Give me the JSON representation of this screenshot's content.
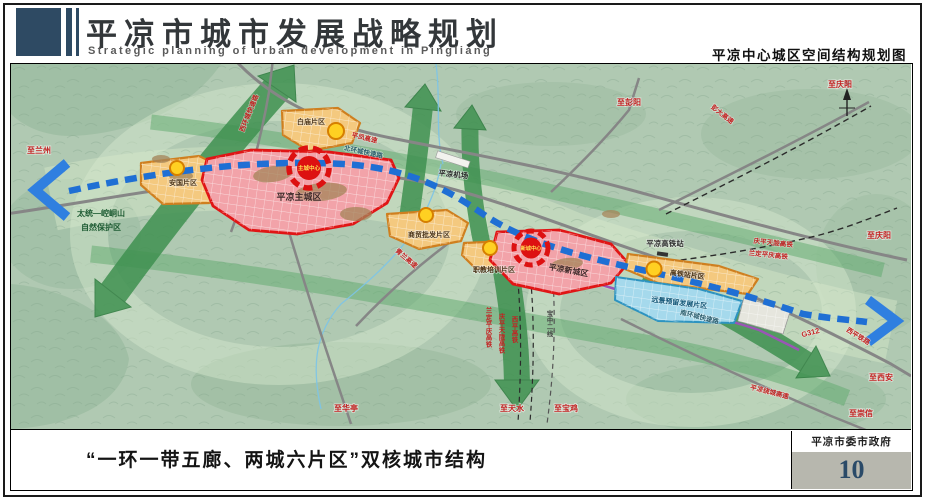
{
  "header": {
    "title": "平凉市城市发展战略规划",
    "subtitle": "Strategic planning of urban development in Pingliang",
    "right_caption": "平凉中心城区空间结构规划图"
  },
  "footer": {
    "caption": "“一环一带五廊、两城六片区”双核城市结构",
    "agency": "平凉市委市政府",
    "page_number": "10"
  },
  "map": {
    "compass_label": "N",
    "districts": {
      "main_city": "平凉主城区",
      "new_city": "平凉新城区",
      "anguo": "安国片区",
      "baimiao": "白庙片区",
      "trade_wholesale": "商贸批发片区",
      "vocational": "职教培训片区",
      "hsr_area": "高铁站片区",
      "reserved": "远景预留发展片区"
    },
    "centers": {
      "main_center": "主城中心",
      "new_center": "新城中心"
    },
    "nature_reserve": {
      "line1": "太统—崆峒山",
      "line2": "自然保护区"
    },
    "facilities": {
      "airport": "平凉机场",
      "hsr_station": "平凉高铁站"
    },
    "roads": {
      "west_ring": "西环城快速路",
      "north_ring": "北环城快速路",
      "south_ring": "南环城快速路",
      "pengda_expressway": "彭大高速",
      "pingfeng_expressway": "平凤高速",
      "qinglan_expressway": "青兰高速",
      "ring_expressway": "平凉绕城高速",
      "g312": "G312"
    },
    "railways": {
      "qptl_hsr_right": "庆平天陇高铁",
      "ldpq_hsr_right": "兰定平庆高铁",
      "ldpq_hsr_south": "兰定平庆高铁",
      "qptl_hsr_south": "庆平天陇高铁",
      "xiping_hsr": "西平高铁",
      "baozhong_line2": "宝中二线",
      "xiping_railway": "西平铁路"
    },
    "directions": {
      "to_lanzhou": "至兰州",
      "to_pengyang": "至彭阳",
      "to_qingyang_top": "至庆阳",
      "to_qingyang_right": "至庆阳",
      "to_xian": "至西安",
      "to_chongxin": "至崇信",
      "to_huating": "至华亭",
      "to_tianshui": "至天水",
      "to_baoji": "至宝鸡"
    }
  },
  "colors": {
    "header_navy": "#2e4a63",
    "district_red_border": "#e01515",
    "district_pink_fill": "#f2a3a9",
    "district_orange_border": "#cf7f1f",
    "district_orange_fill": "#f4c97f",
    "reserved_blue_fill": "#a5d9ec",
    "corridor_green": "#3f9150",
    "transit_blue": "#1f6fd4",
    "label_red": "#c32222",
    "page_number_blue": "#2a4a68",
    "footer_gray": "#b7b7ae"
  }
}
